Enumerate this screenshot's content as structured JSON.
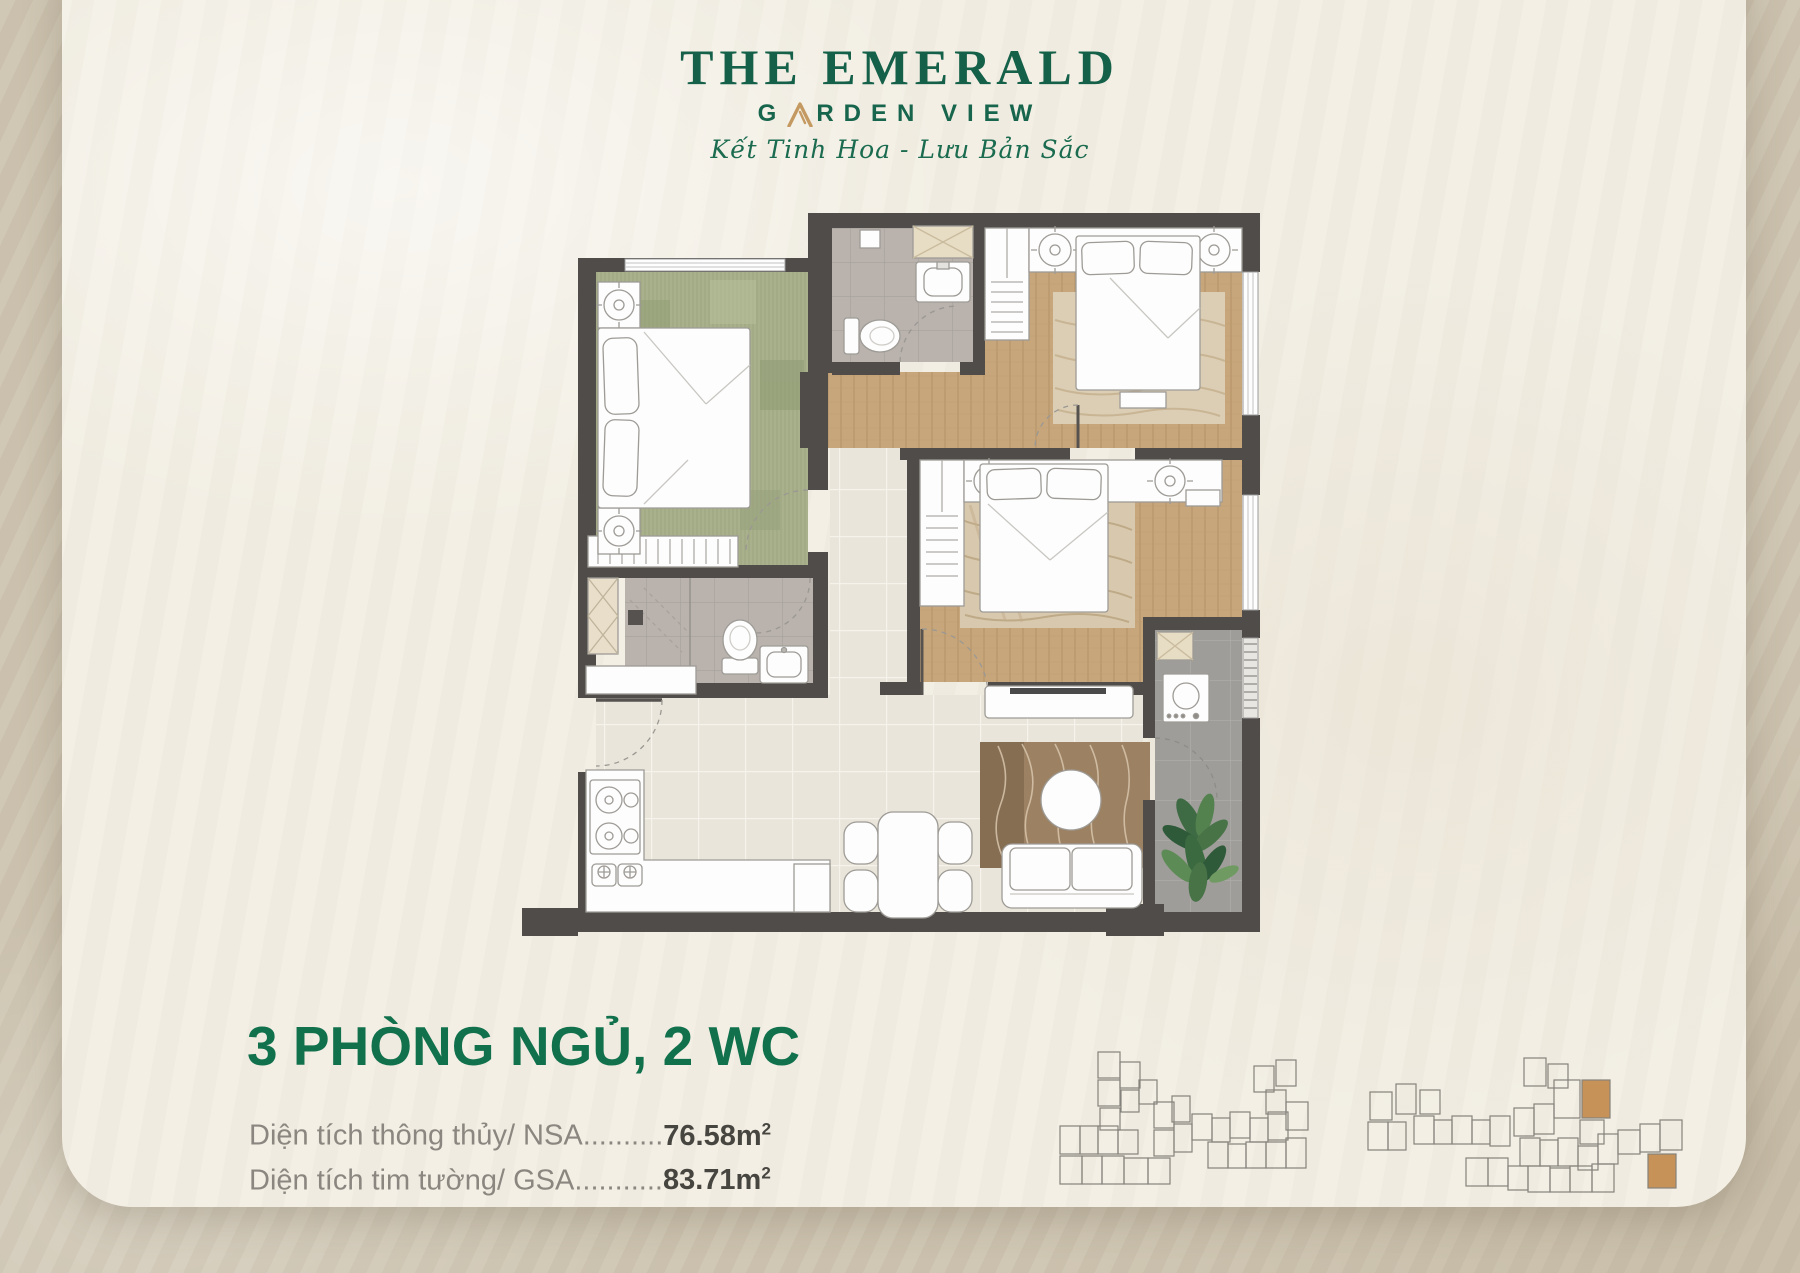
{
  "logo": {
    "title": "THE EMERALD",
    "subtitle_left": "G",
    "subtitle_right": "RDEN VIEW",
    "tagline": "Kết Tinh Hoa - Lưu Bản Sắc"
  },
  "unit_info": {
    "heading": "3 PHÒNG NGỦ, 2 WC",
    "rows": [
      {
        "label": "Diện tích thông thủy/ NSA",
        "dots": "..........",
        "value": "76.58",
        "unit": "m",
        "sup": "2"
      },
      {
        "label": "Diện tích tim tường/ GSA",
        "dots": "...........",
        "value": "83.71",
        "unit": "m",
        "sup": "2"
      }
    ]
  },
  "colors": {
    "brand_green": "#156049",
    "heading_green": "#12714d",
    "gold": "#c49a62",
    "wall_gray": "#4f4c49",
    "highlight_unit_orange": "#c79257",
    "card_cream": "#f2eee3",
    "background_beige": "#cec4b0"
  }
}
